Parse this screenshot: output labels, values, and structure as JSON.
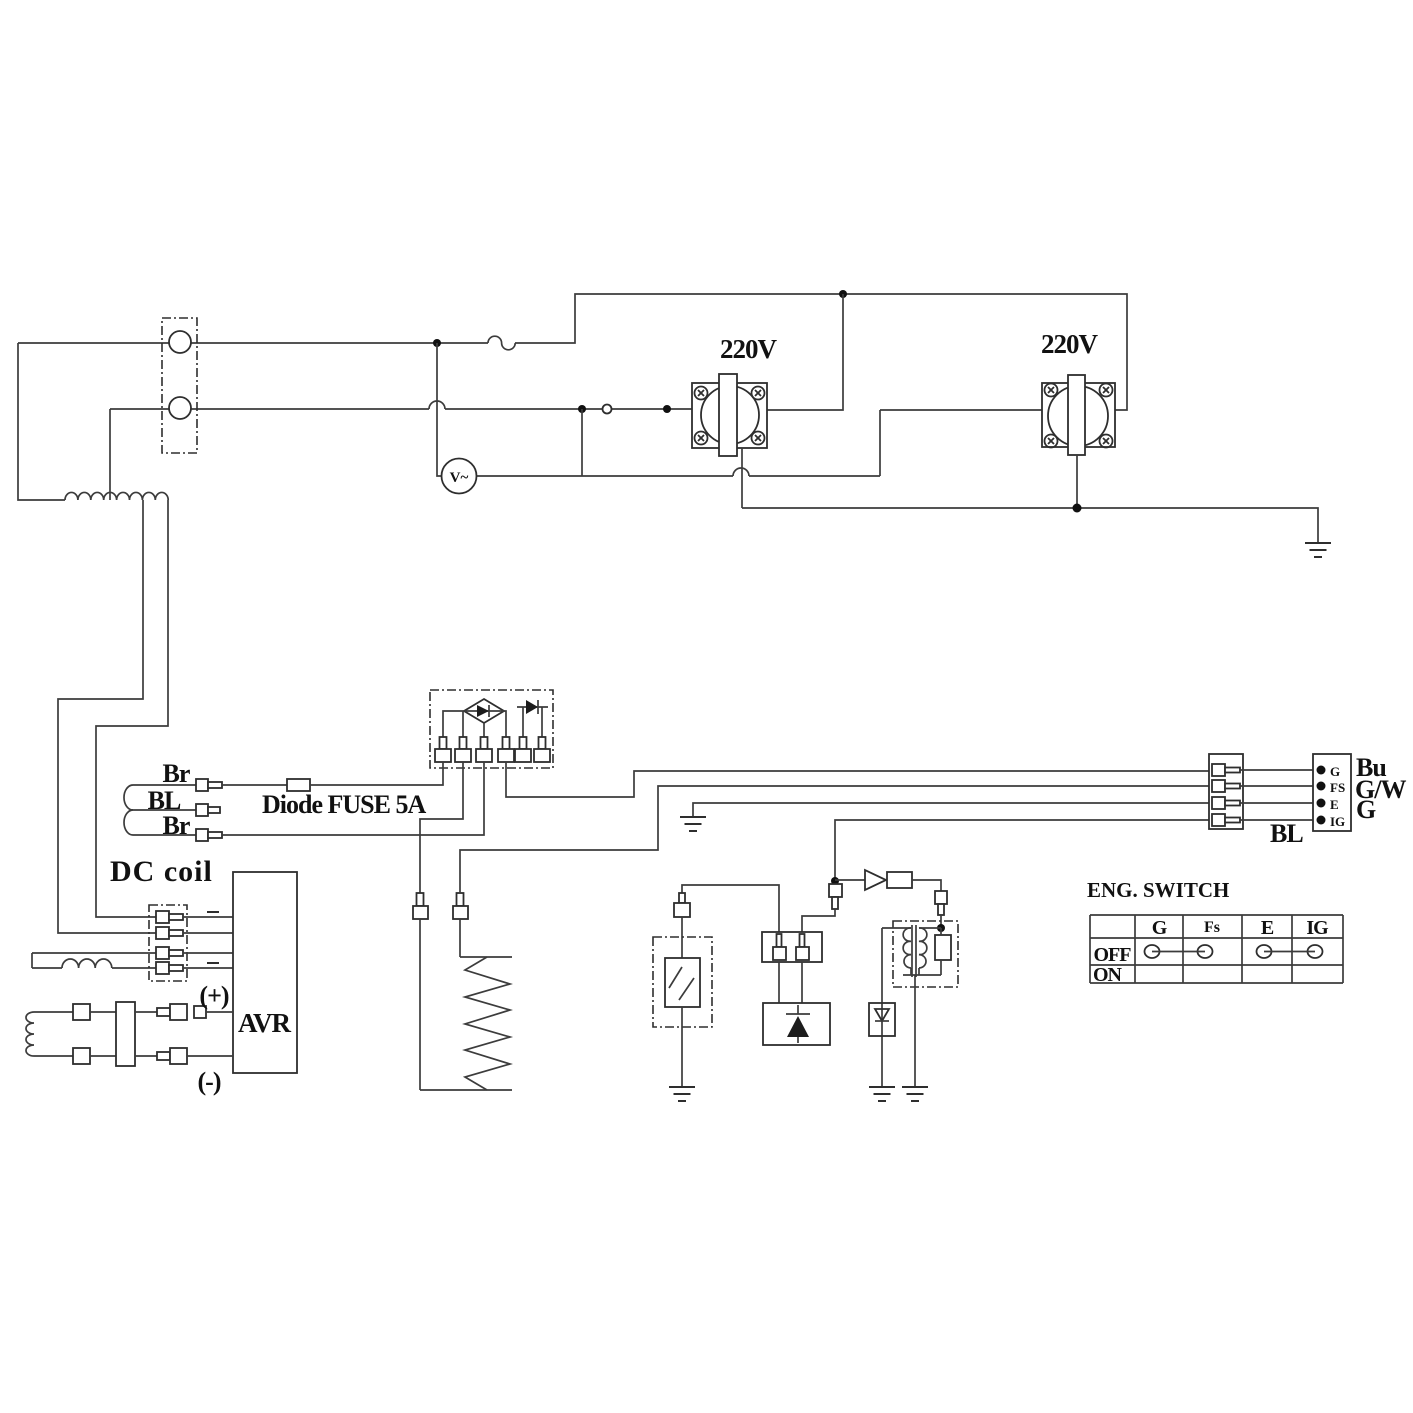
{
  "labels": {
    "outlet1": "220V",
    "outlet2": "220V",
    "voltmeter": "V~",
    "br_top": "Br",
    "bl": "BL",
    "br_bottom": "Br",
    "fuse": "Diode FUSE 5A",
    "dc_coil": "DC coil",
    "avr": "AVR",
    "plus": "(+)",
    "minus": "(-)"
  },
  "connector": {
    "pins": [
      "G",
      "FS",
      "E",
      "IG"
    ],
    "wire_colors": [
      "Bu",
      "G/W",
      "G"
    ],
    "bl_wire": "BL"
  },
  "eng_switch": {
    "title": "ENG. SWITCH",
    "columns": [
      "G",
      "Fs",
      "E",
      "IG"
    ],
    "row_off": "OFF",
    "row_on": "ON"
  }
}
